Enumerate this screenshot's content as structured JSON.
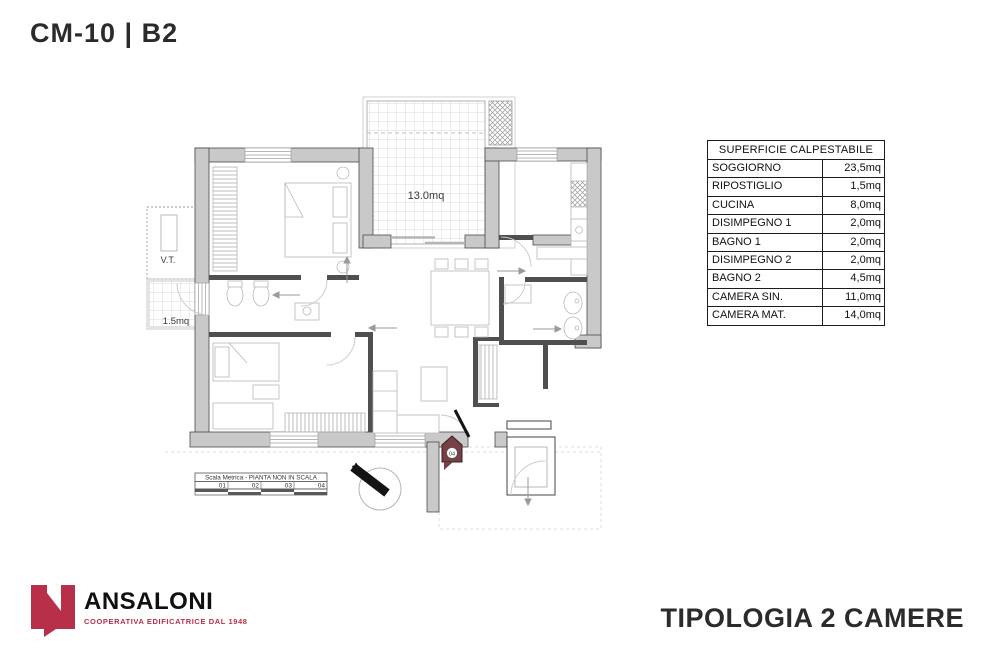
{
  "page": {
    "plan_code": "CM-10 | B2",
    "typology_title": "TIPOLOGIA 2 CAMERE"
  },
  "areas_table": {
    "header": "SUPERFICIE CALPESTABILE",
    "rows": [
      {
        "room": "SOGGIORNO",
        "area": "23,5mq"
      },
      {
        "room": "RIPOSTIGLIO",
        "area": "1,5mq"
      },
      {
        "room": "CUCINA",
        "area": "8,0mq"
      },
      {
        "room": "DISIMPEGNO 1",
        "area": "2,0mq"
      },
      {
        "room": "BAGNO 1",
        "area": "2,0mq"
      },
      {
        "room": "DISIMPEGNO 2",
        "area": "2,0mq"
      },
      {
        "room": "BAGNO 2",
        "area": "4,5mq"
      },
      {
        "room": "CAMERA SIN.",
        "area": "11,0mq"
      },
      {
        "room": "CAMERA MAT.",
        "area": "14,0mq"
      }
    ]
  },
  "plan": {
    "terrace_area_label": "13.0mq",
    "balcony_area_label": "1.5mq",
    "vt_label": "V.T.",
    "unit_badge": "04",
    "north_label": "N",
    "scale_bar": {
      "title": "Scala Metrica - PIANTA NON IN SCALA",
      "ticks": [
        "01",
        "02",
        "03",
        "04"
      ]
    }
  },
  "logo": {
    "name": "ANSALONI",
    "tagline": "COOPERATIVA EDIFICATRICE DAL 1948"
  },
  "colors": {
    "accent_red": "#b82f4a",
    "badge_maroon": "#7a3f45",
    "wall_gray": "#c9c9c9",
    "wall_outline": "#4a4a4a"
  }
}
